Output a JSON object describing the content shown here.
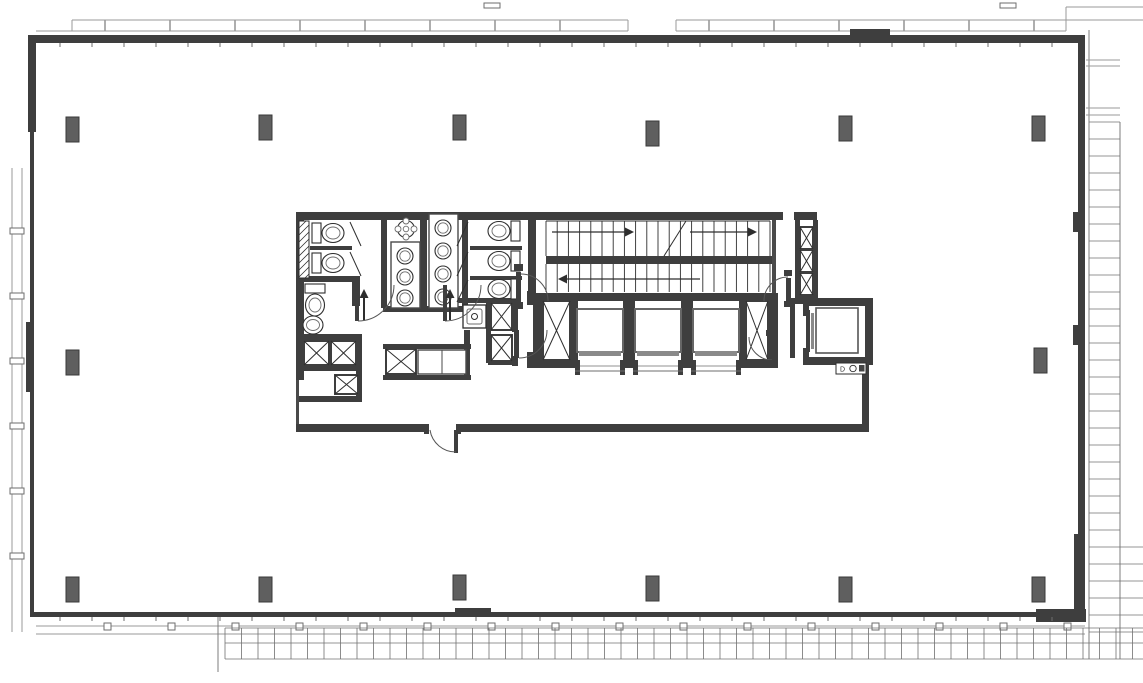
{
  "document": {
    "type": "architectural-floor-plan"
  },
  "canvas": {
    "width": 1143,
    "height": 683,
    "background": "#ffffff"
  },
  "palette": {
    "wall": "#3e3e3e",
    "wall_light": "#4a4a4a",
    "column": "#5f5f5f",
    "ink": "#2e2e2e",
    "mid": "#6e6e6e",
    "light": "#9a9a9a",
    "grid": "#707070",
    "sill": "#8a8a8a",
    "white": "#ffffff"
  },
  "context": {
    "canopy": {
      "upper_y": 20,
      "lower_y": 31,
      "upper_segments": [
        [
          72,
          628
        ],
        [
          676,
          1066
        ]
      ],
      "lower_segments": [
        [
          36,
          628
        ],
        [
          676,
          1066
        ]
      ],
      "tick_step": 65,
      "far_segments": [
        [
          1066,
          1143,
          7
        ],
        [
          1066,
          1143,
          20
        ]
      ],
      "connector": [
        1066,
        7,
        1066,
        31
      ]
    },
    "top_marks": [
      [
        484,
        3,
        16,
        5
      ],
      [
        1000,
        3,
        16,
        5
      ]
    ],
    "left_band": {
      "x1": 12,
      "x2": 22,
      "y1": 168,
      "y2": 632,
      "tick_ys": [
        228,
        293,
        358,
        423,
        488,
        553
      ]
    },
    "bottom_rail": {
      "y1": 626,
      "y2": 634,
      "x1": 36,
      "x2": 1085,
      "tick_x0": 104,
      "tick_step": 64,
      "tick_x_max": 1064
    },
    "bottom_grid": {
      "x1": 225,
      "x2": 1143,
      "rows": [
        628,
        643,
        659
      ],
      "step": 16.5,
      "divider": [
        218,
        617,
        218,
        672
      ]
    },
    "right_grid": {
      "x1": 1089,
      "x2": 1120,
      "x3": 1143,
      "y_top": 30,
      "y1": 122,
      "y2": 659,
      "step": 17,
      "extend_y": 545,
      "pairs": [
        60,
        66,
        108,
        115
      ]
    }
  },
  "shell": {
    "walls": [
      [
        28,
        35,
        1057,
        8
      ],
      [
        28,
        35,
        8,
        97
      ],
      [
        30,
        132,
        4,
        484
      ],
      [
        26,
        322,
        8,
        70
      ],
      [
        1078,
        40,
        7,
        576
      ],
      [
        30,
        612,
        1055,
        5
      ],
      [
        1036,
        609,
        50,
        13
      ],
      [
        1074,
        534,
        11,
        82
      ],
      [
        850,
        29,
        40,
        7
      ],
      [
        455,
        608,
        36,
        8
      ],
      [
        1073,
        212,
        5,
        20
      ],
      [
        1073,
        325,
        5,
        20
      ]
    ],
    "tick_step": 32,
    "top_ticks": {
      "y": 43,
      "len": 4,
      "x1": 60,
      "x2": 1076
    },
    "bottom_ticks": {
      "y": 617,
      "len": 4,
      "x1": 60,
      "x2": 1080
    }
  },
  "columns": {
    "size": [
      13,
      25
    ],
    "positions": [
      [
        66,
        117
      ],
      [
        259,
        115
      ],
      [
        453,
        115
      ],
      [
        646,
        121
      ],
      [
        839,
        116
      ],
      [
        1032,
        116
      ],
      [
        66,
        350
      ],
      [
        1034,
        348
      ],
      [
        66,
        577
      ],
      [
        259,
        577
      ],
      [
        453,
        575
      ],
      [
        646,
        576
      ],
      [
        839,
        577
      ],
      [
        1032,
        577
      ]
    ]
  },
  "core": {
    "walls": [
      [
        296,
        212,
        521,
        8
      ],
      [
        296,
        212,
        8,
        168
      ],
      [
        296,
        424,
        573,
        8
      ],
      [
        862,
        357,
        7,
        75
      ],
      [
        420,
        212,
        7,
        98
      ],
      [
        381,
        212,
        6,
        96
      ],
      [
        462,
        212,
        6,
        96
      ],
      [
        528,
        212,
        8,
        88
      ],
      [
        296,
        276,
        64,
        6
      ],
      [
        310,
        246,
        42,
        4
      ],
      [
        470,
        246,
        52,
        4
      ],
      [
        470,
        276,
        52,
        4
      ],
      [
        352,
        278,
        8,
        28
      ],
      [
        296,
        334,
        66,
        6
      ],
      [
        296,
        366,
        66,
        5
      ],
      [
        296,
        396,
        66,
        6
      ],
      [
        356,
        334,
        6,
        68
      ],
      [
        383,
        344,
        88,
        5
      ],
      [
        383,
        375,
        88,
        5
      ],
      [
        464,
        330,
        6,
        50
      ],
      [
        383,
        306,
        80,
        6
      ],
      [
        455,
        298,
        62,
        5
      ],
      [
        486,
        303,
        5,
        60
      ],
      [
        512,
        298,
        6,
        34
      ],
      [
        512,
        356,
        6,
        10
      ],
      [
        488,
        360,
        28,
        5
      ],
      [
        795,
        220,
        5,
        82
      ],
      [
        813,
        220,
        5,
        82
      ],
      [
        795,
        296,
        23,
        8
      ],
      [
        790,
        298,
        5,
        60
      ],
      [
        803,
        298,
        70,
        8
      ],
      [
        865,
        298,
        8,
        67
      ],
      [
        803,
        357,
        70,
        8
      ],
      [
        803,
        306,
        6,
        10
      ],
      [
        803,
        348,
        6,
        12
      ],
      [
        533,
        293,
        245,
        8
      ],
      [
        533,
        360,
        245,
        8
      ],
      [
        533,
        293,
        10,
        75
      ],
      [
        768,
        293,
        10,
        75
      ],
      [
        570,
        301,
        8,
        59
      ],
      [
        623,
        301,
        12,
        59
      ],
      [
        681,
        301,
        12,
        59
      ],
      [
        739,
        301,
        8,
        59
      ],
      [
        527,
        291,
        6,
        14
      ],
      [
        527,
        352,
        6,
        16
      ],
      [
        546,
        256,
        226,
        8
      ],
      [
        457,
        351,
        8,
        16
      ]
    ],
    "white_gaps": [
      [
        783,
        212,
        11,
        8
      ],
      [
        580,
        360,
        40,
        8
      ],
      [
        638,
        360,
        40,
        8
      ],
      [
        696,
        360,
        40,
        8
      ],
      [
        428,
        424,
        28,
        8
      ]
    ],
    "thin_walls": [
      [
        772,
        220,
        4,
        73
      ],
      [
        296,
        380,
        3,
        44
      ]
    ],
    "hatch": {
      "rect": [
        299,
        221,
        10,
        57
      ],
      "step": 7
    },
    "x_shafts": [
      [
        304,
        341,
        25,
        24
      ],
      [
        331,
        341,
        25,
        24
      ],
      [
        335,
        375,
        23,
        19
      ],
      [
        386,
        349,
        30,
        25
      ],
      [
        491,
        303,
        21,
        27
      ],
      [
        491,
        335,
        21,
        26
      ],
      [
        543,
        301,
        27,
        59
      ],
      [
        746,
        301,
        22,
        59
      ],
      [
        800,
        227,
        13,
        22
      ],
      [
        800,
        250,
        13,
        22
      ],
      [
        800,
        273,
        13,
        22
      ]
    ],
    "stall_lines": [
      [
        350,
        222,
        361,
        246
      ],
      [
        350,
        252,
        361,
        276
      ],
      [
        468,
        222,
        457,
        246
      ],
      [
        468,
        252,
        457,
        276
      ],
      [
        468,
        280,
        457,
        302
      ]
    ],
    "counters": [
      [
        391,
        242,
        29,
        66
      ],
      [
        429,
        214,
        29,
        94
      ],
      [
        418,
        350,
        48,
        24
      ]
    ],
    "counter_dividers": [
      [
        442,
        350,
        442,
        374
      ]
    ],
    "toilets": [
      {
        "x": 312,
        "y": 222,
        "dir": "left"
      },
      {
        "x": 312,
        "y": 252,
        "dir": "left"
      },
      {
        "x": 304,
        "y": 284,
        "dir": "down"
      },
      {
        "x": 486,
        "y": 220,
        "dir": "right"
      },
      {
        "x": 486,
        "y": 250,
        "dir": "right"
      },
      {
        "x": 486,
        "y": 278,
        "dir": "right"
      }
    ],
    "sinks": [
      [
        405,
        256
      ],
      [
        405,
        277
      ],
      [
        405,
        298
      ],
      [
        443,
        228
      ],
      [
        443,
        251
      ],
      [
        443,
        274
      ],
      [
        443,
        297
      ]
    ],
    "basin": [
      313,
      325
    ],
    "ornate_sink": [
      406,
      229
    ],
    "mop_sink": [
      463,
      305,
      23,
      23
    ],
    "fountain": {
      "rect": [
        836,
        363,
        30,
        11
      ],
      "circle": [
        853,
        368.5,
        3.2
      ],
      "square": [
        859,
        365,
        5.5,
        6.5
      ],
      "label": "D"
    },
    "stairs": {
      "x1": 546,
      "x2": 770,
      "treads": 20,
      "flight1": [
        221,
        256
      ],
      "flight2": [
        264,
        292
      ],
      "break_line": [
        664,
        256,
        686,
        221
      ],
      "arrows": [
        {
          "line": [
            552,
            232,
            626,
            232
          ],
          "head": [
            634,
            232
          ],
          "dirn": "right"
        },
        {
          "line": [
            690,
            232,
            748,
            232
          ],
          "head": [
            757,
            232
          ],
          "dirn": "right"
        },
        {
          "line": [
            566,
            279,
            700,
            279
          ],
          "head": [
            558,
            279
          ],
          "dirn": "left"
        }
      ]
    },
    "elevators": {
      "cabs": [
        [
          577,
          309,
          46,
          43
        ],
        [
          635,
          309,
          46,
          43
        ],
        [
          693,
          309,
          46,
          43
        ]
      ],
      "sills": [
        [
          579,
          351,
          42,
          5
        ],
        [
          637,
          351,
          42,
          5
        ],
        [
          695,
          351,
          42,
          5
        ]
      ],
      "door_gaps": [
        [
          580,
          620
        ],
        [
          638,
          678
        ],
        [
          696,
          736
        ]
      ],
      "freight_cab": [
        816,
        308,
        42,
        45
      ],
      "freight_panels": [
        [
          806,
          310,
          4,
          42
        ],
        [
          811,
          313,
          3,
          36
        ]
      ]
    },
    "doors": [
      {
        "leaf": [
          355,
          284,
          4,
          37
        ],
        "arc": "M 358 321 A 36 36 0 0 0 394 285"
      },
      {
        "leaf": [
          443,
          285,
          4,
          36
        ],
        "arc": "M 445 321 A 36 36 0 0 0 481 285"
      },
      {
        "leaf": [
          516,
          272,
          5,
          30
        ],
        "arc": "M 521 274 A 27 27 0 0 1 548 301"
      },
      {
        "leaf": [
          514,
          330,
          5,
          28
        ],
        "arc": "M 519 358 A 28 28 0 0 0 547 330"
      },
      {
        "leaf": [
          786,
          278,
          5,
          23
        ],
        "arc": "M 788 277 A 24 24 0 0 0 764 301"
      },
      {
        "leaf": [
          770,
          337,
          5,
          23
        ],
        "arc": "M 772 360 A 23 23 0 0 1 749 337"
      },
      {
        "leaf": [
          454,
          430,
          4,
          23
        ],
        "arc": "M 456 452 A 26 26 0 0 1 430 430"
      }
    ],
    "jambs": [
      [
        424,
        424,
        5,
        10
      ],
      [
        456,
        424,
        5,
        10
      ],
      [
        514,
        264,
        9,
        7
      ],
      [
        514,
        302,
        9,
        7
      ],
      [
        784,
        270,
        8,
        6
      ],
      [
        784,
        301,
        8,
        6
      ],
      [
        766,
        330,
        8,
        6
      ],
      [
        766,
        360,
        8,
        6
      ]
    ],
    "egress_arrows": [
      [
        364,
        320,
        364,
        298
      ],
      [
        450,
        320,
        450,
        298
      ]
    ]
  }
}
